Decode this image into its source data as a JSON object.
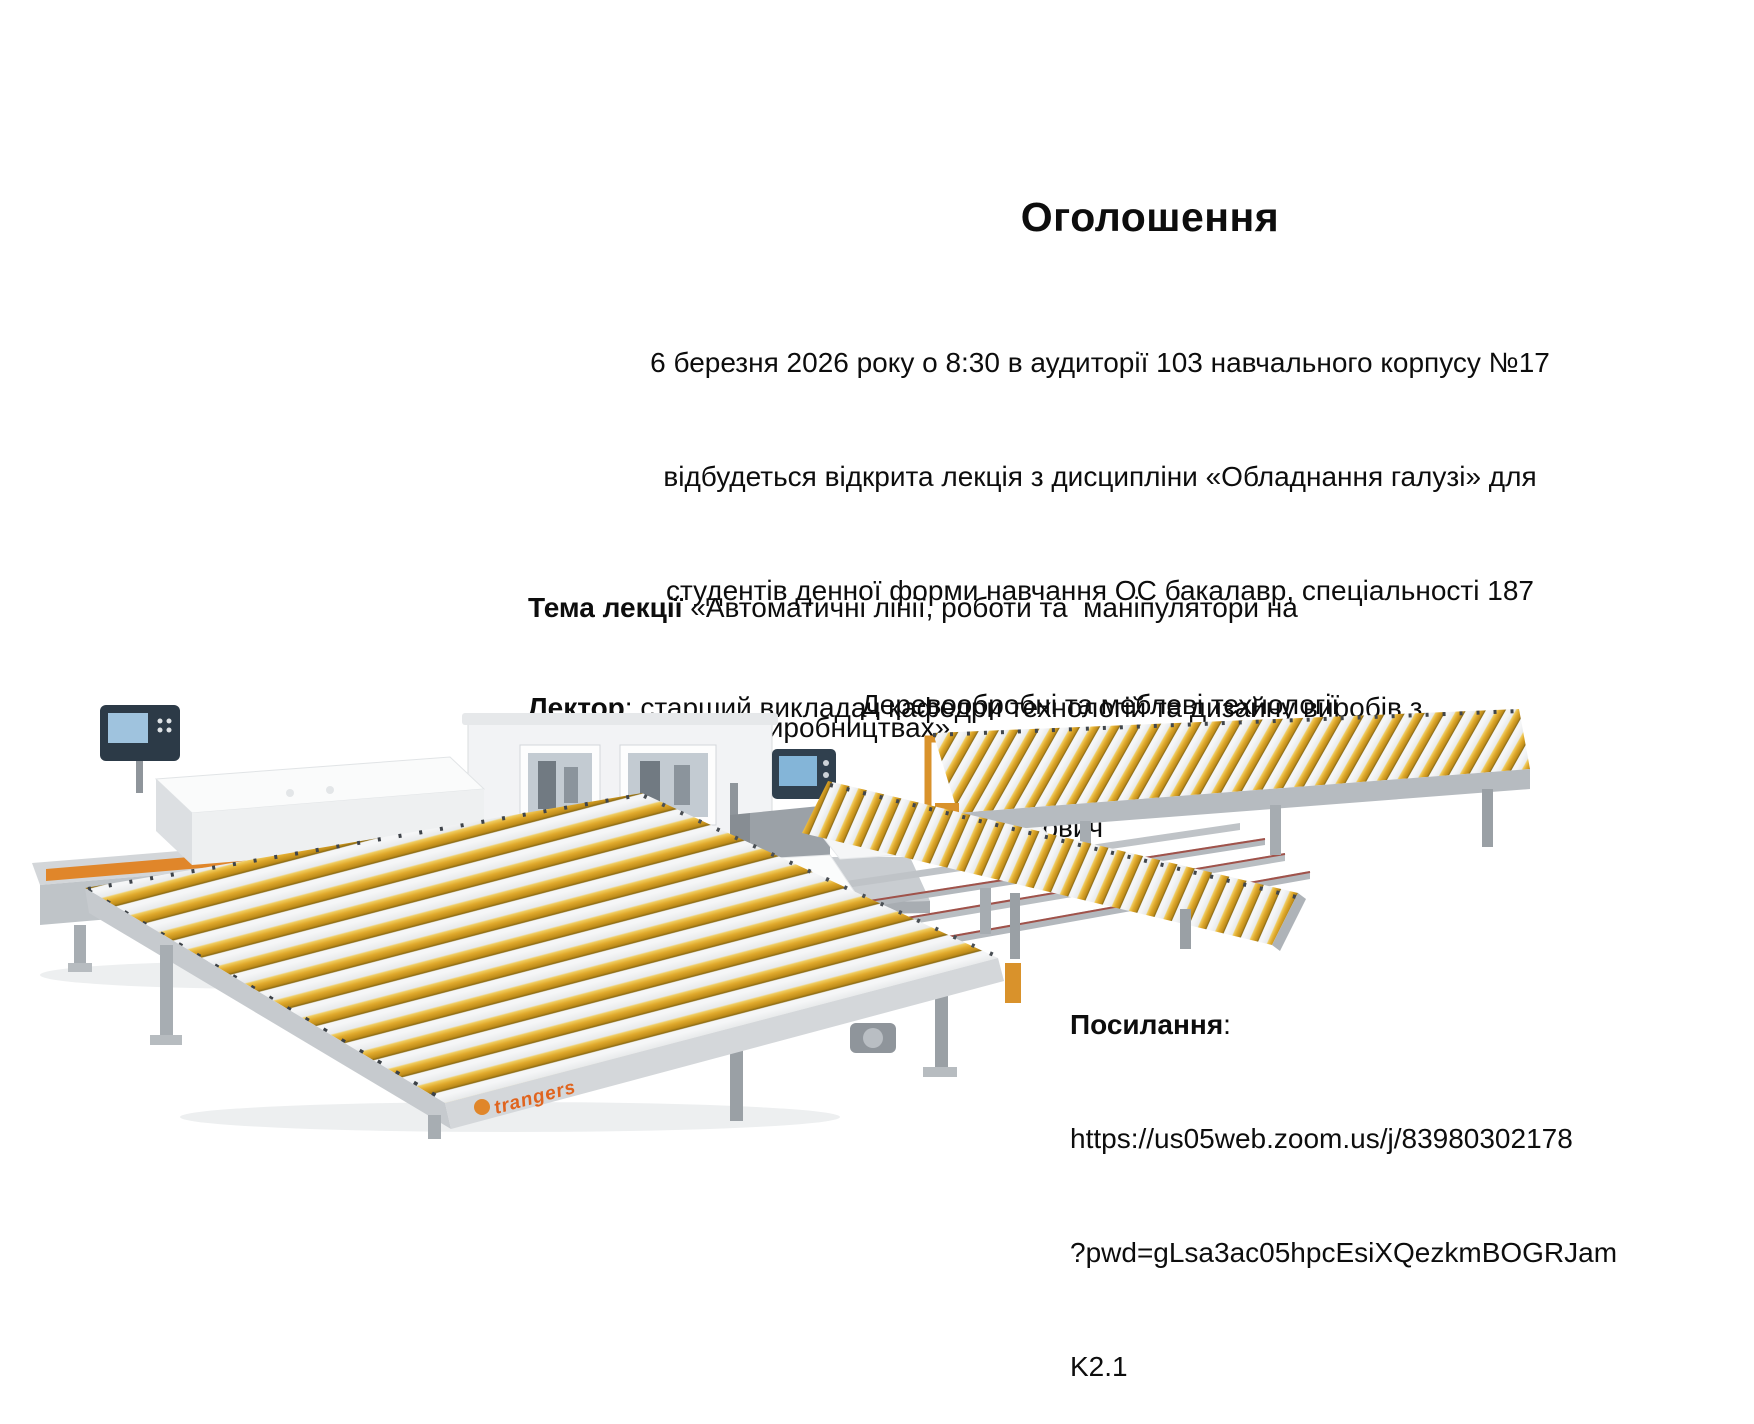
{
  "slide": {
    "title": "Оголошення",
    "intro_lines": [
      "6 березня 2026 року о 8:30 в аудиторії 103 навчального корпусу №17",
      "відбудеться відкрита лекція з дисципліни «Обладнання галузі» для",
      "студентів денної форми навчання ОС бакалавр, спеціальності 187",
      "Деревообробні та меблеві технології"
    ],
    "topic": {
      "label": "Тема лекції",
      "line1_rest": " «Автоматичні лінії, роботи та  маніпулятори на",
      "line2": "деревообробних виробництвах»"
    },
    "lecturer": {
      "label": "Лектор",
      "line1_rest": ": старший викладач кафедри технологій та дизайну виробів з",
      "line2": "деревини, Ph. D. Зав’ялов Денис Лазарович"
    },
    "link": {
      "label": "Посилання",
      "colon": ":",
      "lines": [
        "https://us05web.zoom.us/j/83980302178",
        "?pwd=gLsa3ac05hpcEsiXQezkmBOGRJam",
        "K2.1"
      ]
    }
  },
  "photo": {
    "description": "Automatic woodworking line: two edge-banding machines with control panels and yellow roller conveyor tables",
    "brand_text": "trangers",
    "colors": {
      "roller_yellow": "#e0a92c",
      "frame_gray": "#bfc4c8",
      "machine_white": "#f2f3f5",
      "accent_orange": "#e0862a",
      "panel_dark": "#2c3a47"
    }
  }
}
